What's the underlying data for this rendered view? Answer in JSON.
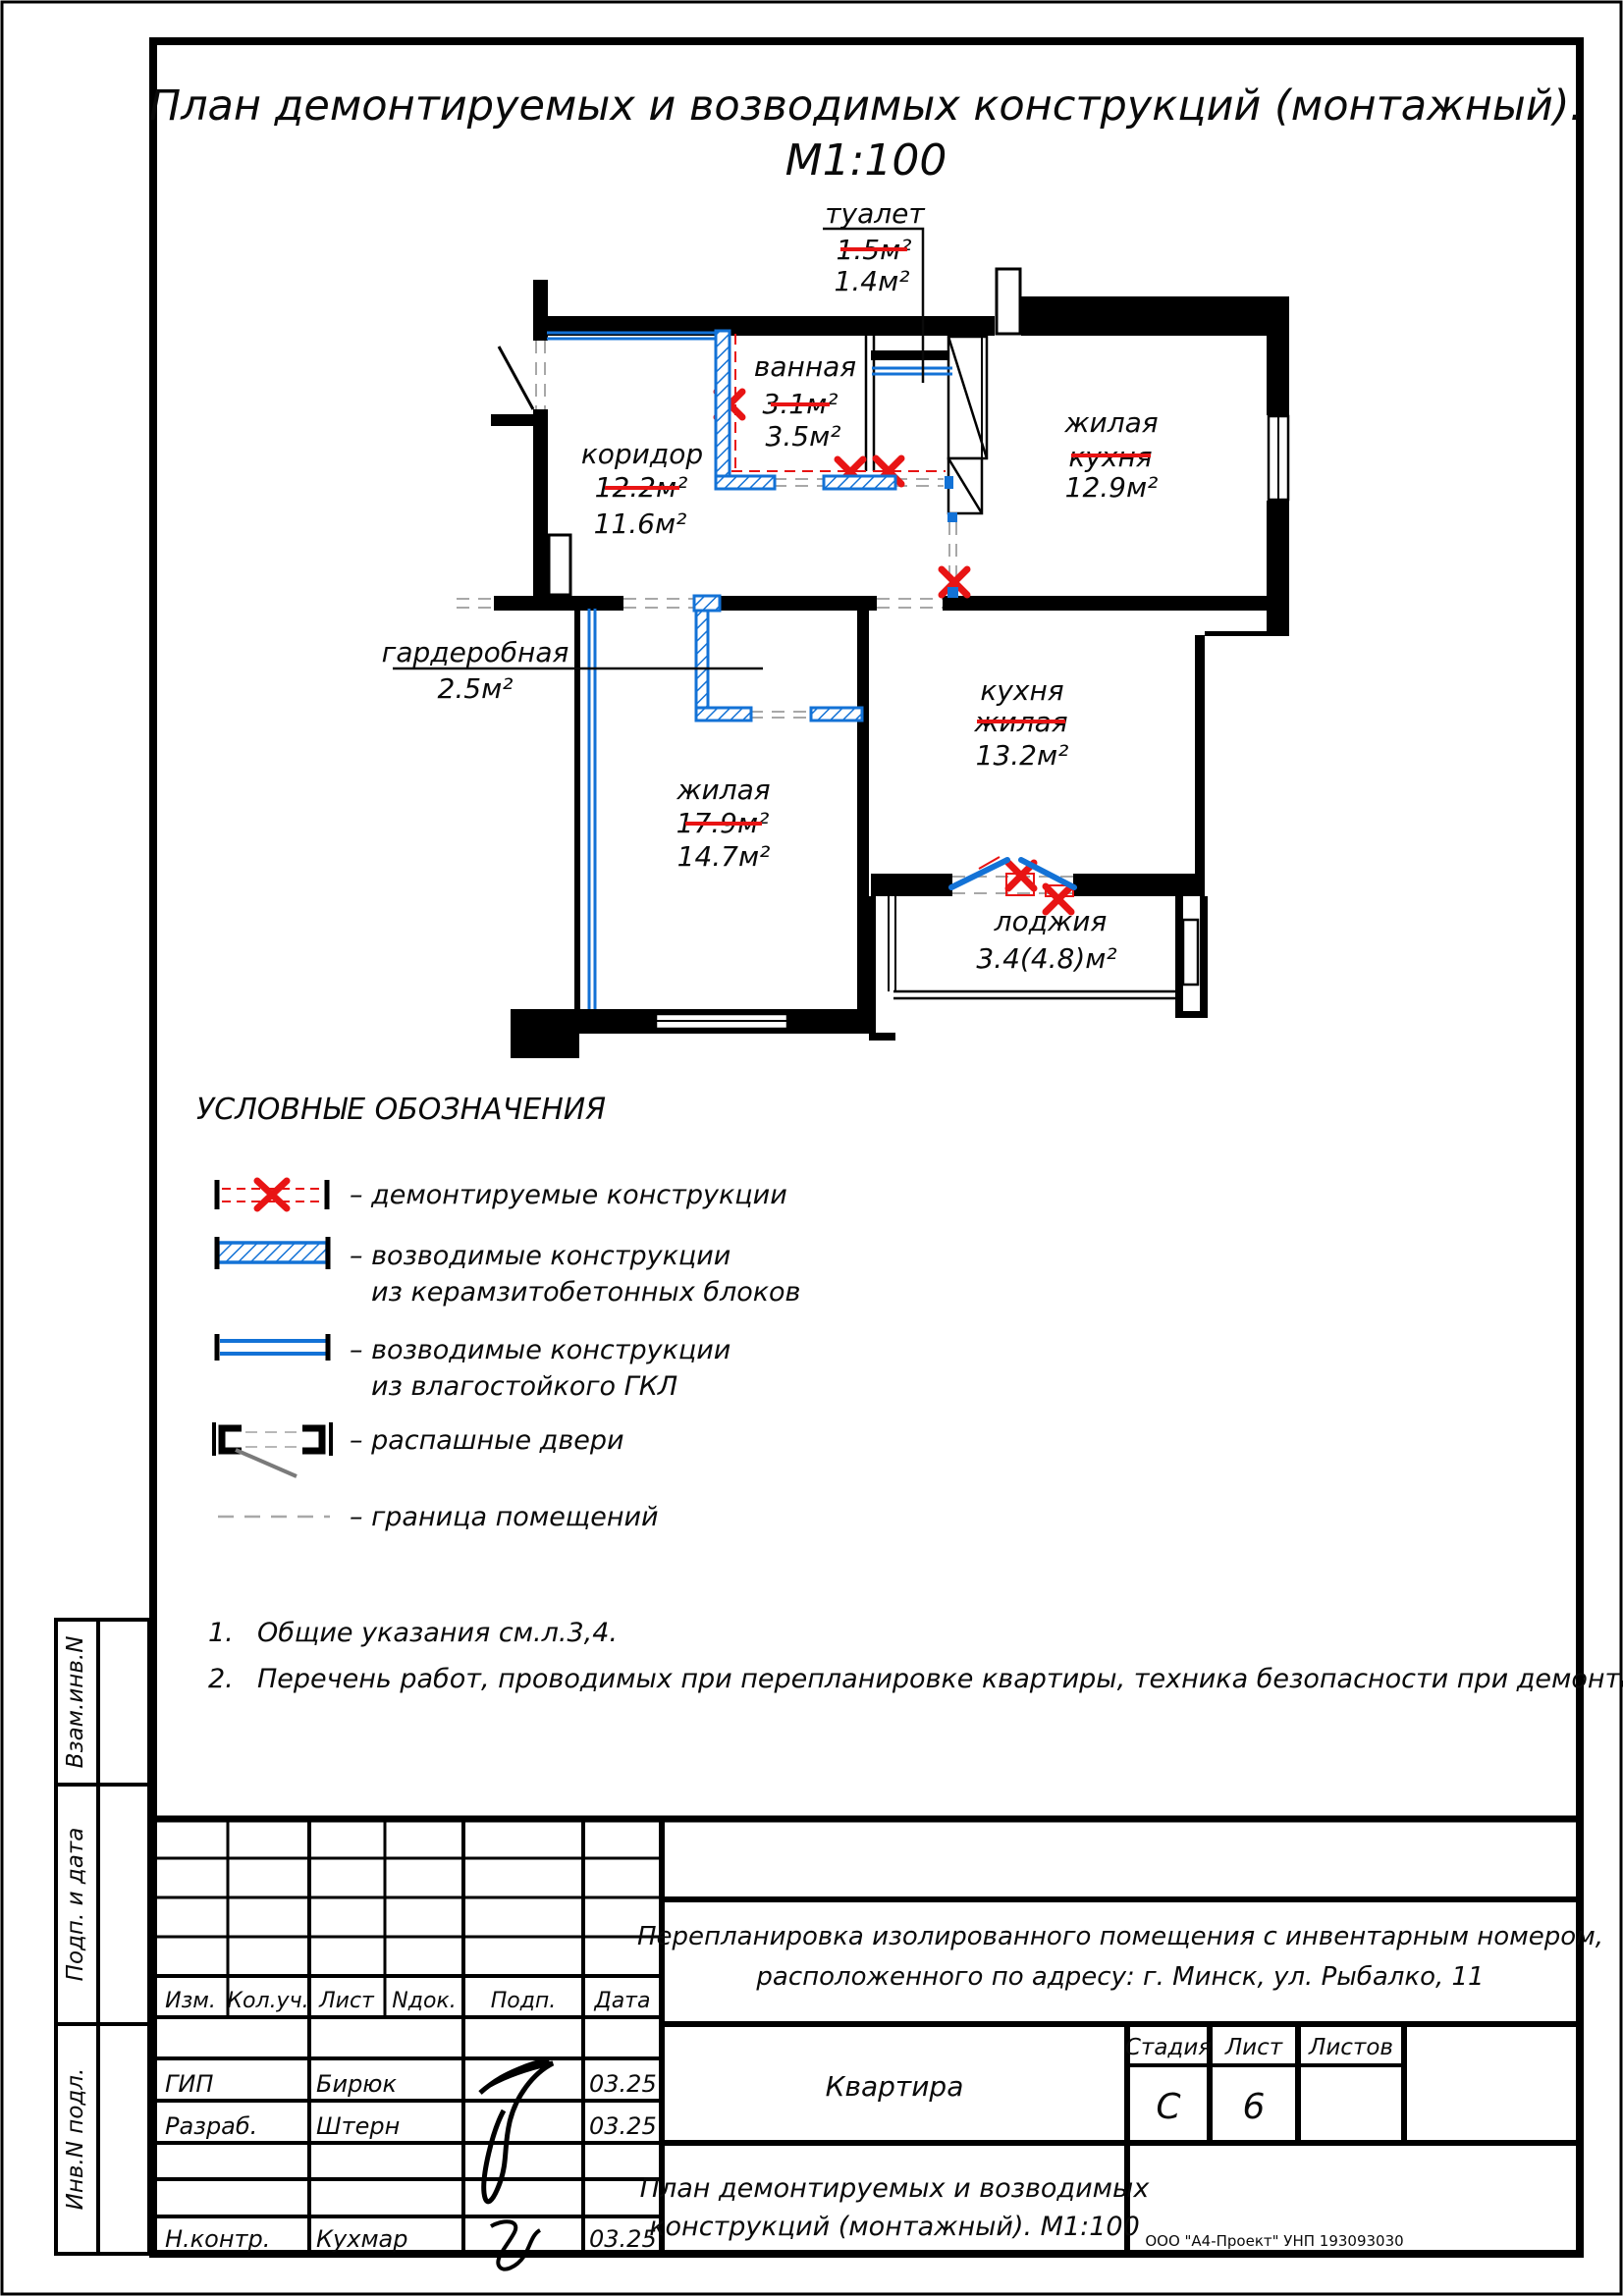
{
  "page_title": {
    "line1": "План демонтируемых и возводимых конструкций (монтажный).",
    "line2": "М1:100"
  },
  "plan": {
    "rooms": [
      {
        "id": "toilet",
        "name": "туалет",
        "old": "1.5м²",
        "new": "1.4м²"
      },
      {
        "id": "bathroom",
        "name": "ванная",
        "old": "3.1м²",
        "new": "3.5м²"
      },
      {
        "id": "corridor",
        "name": "коридор",
        "old": "12.2м²",
        "new": "11.6м²"
      },
      {
        "id": "living-top-right",
        "name": "жилая",
        "old_name": "кухня",
        "area": "12.9м²"
      },
      {
        "id": "wardrobe",
        "name": "гардеробная",
        "area": "2.5м²"
      },
      {
        "id": "living-bottom-left",
        "name": "жилая",
        "old": "17.9м²",
        "new": "14.7м²"
      },
      {
        "id": "kitchen",
        "name": "кухня",
        "old_name": "жилая",
        "area": "13.2м²"
      },
      {
        "id": "loggia",
        "name": "лоджия",
        "area": "3.4(4.8)м²"
      }
    ]
  },
  "legend": {
    "title": "УСЛОВНЫЕ ОБОЗНАЧЕНИЯ",
    "items": [
      {
        "label": "–  демонтируемые конструкции",
        "label2": ""
      },
      {
        "label": "–  возводимые конструкции",
        "label2": "из керамзитобетонных блоков"
      },
      {
        "label": "–  возводимые конструкции",
        "label2": "из влагостойкого ГКЛ"
      },
      {
        "label": "–  распашные двери",
        "label2": ""
      },
      {
        "label": "–  граница помещений",
        "label2": ""
      }
    ]
  },
  "notes": [
    {
      "num": "1.",
      "text": "Общие указания см.л.3,4."
    },
    {
      "num": "2.",
      "text": "Перечень работ, проводимых при перепланировке квартиры, техника безопасности при демонтаже см.л.7."
    }
  ],
  "titleblock": {
    "header_cols": [
      "Изм.",
      "Кол.уч.",
      "Лист",
      "Nдок.",
      "Подп.",
      "Дата"
    ],
    "rows": [
      {
        "role": "ГИП",
        "name": "Бирюк",
        "date": "03.25"
      },
      {
        "role": "Разраб.",
        "name": "Штерн",
        "date": "03.25"
      },
      {
        "role": "Н.контр.",
        "name": "Кухмар",
        "date": "03.25"
      }
    ],
    "project_line1": "Перепланировка изолированного помещения с инвентарным номером,",
    "project_line2": "расположенного по адресу: г. Минск, ул. Рыбалко, 11",
    "object_name": "Квартира",
    "stage_label": "Стадия",
    "stage_value": "С",
    "sheet_label": "Лист",
    "sheet_value": "6",
    "sheets_label": "Листов",
    "sheets_value": "",
    "doc_title_line1": "План демонтируемых и возводимых",
    "doc_title_line2": "конструкций (монтажный). М1:100",
    "company": "ООО \"А4-Проект\"  УНП 193093030"
  },
  "sidebar": {
    "labels": [
      "Взам.инв.N",
      "Подп. и дата",
      "Инв.N подл."
    ]
  },
  "colors": {
    "new_blue": "#1372d6",
    "demolish_red": "#e81414",
    "boundary_gray": "#a8a8a8"
  }
}
